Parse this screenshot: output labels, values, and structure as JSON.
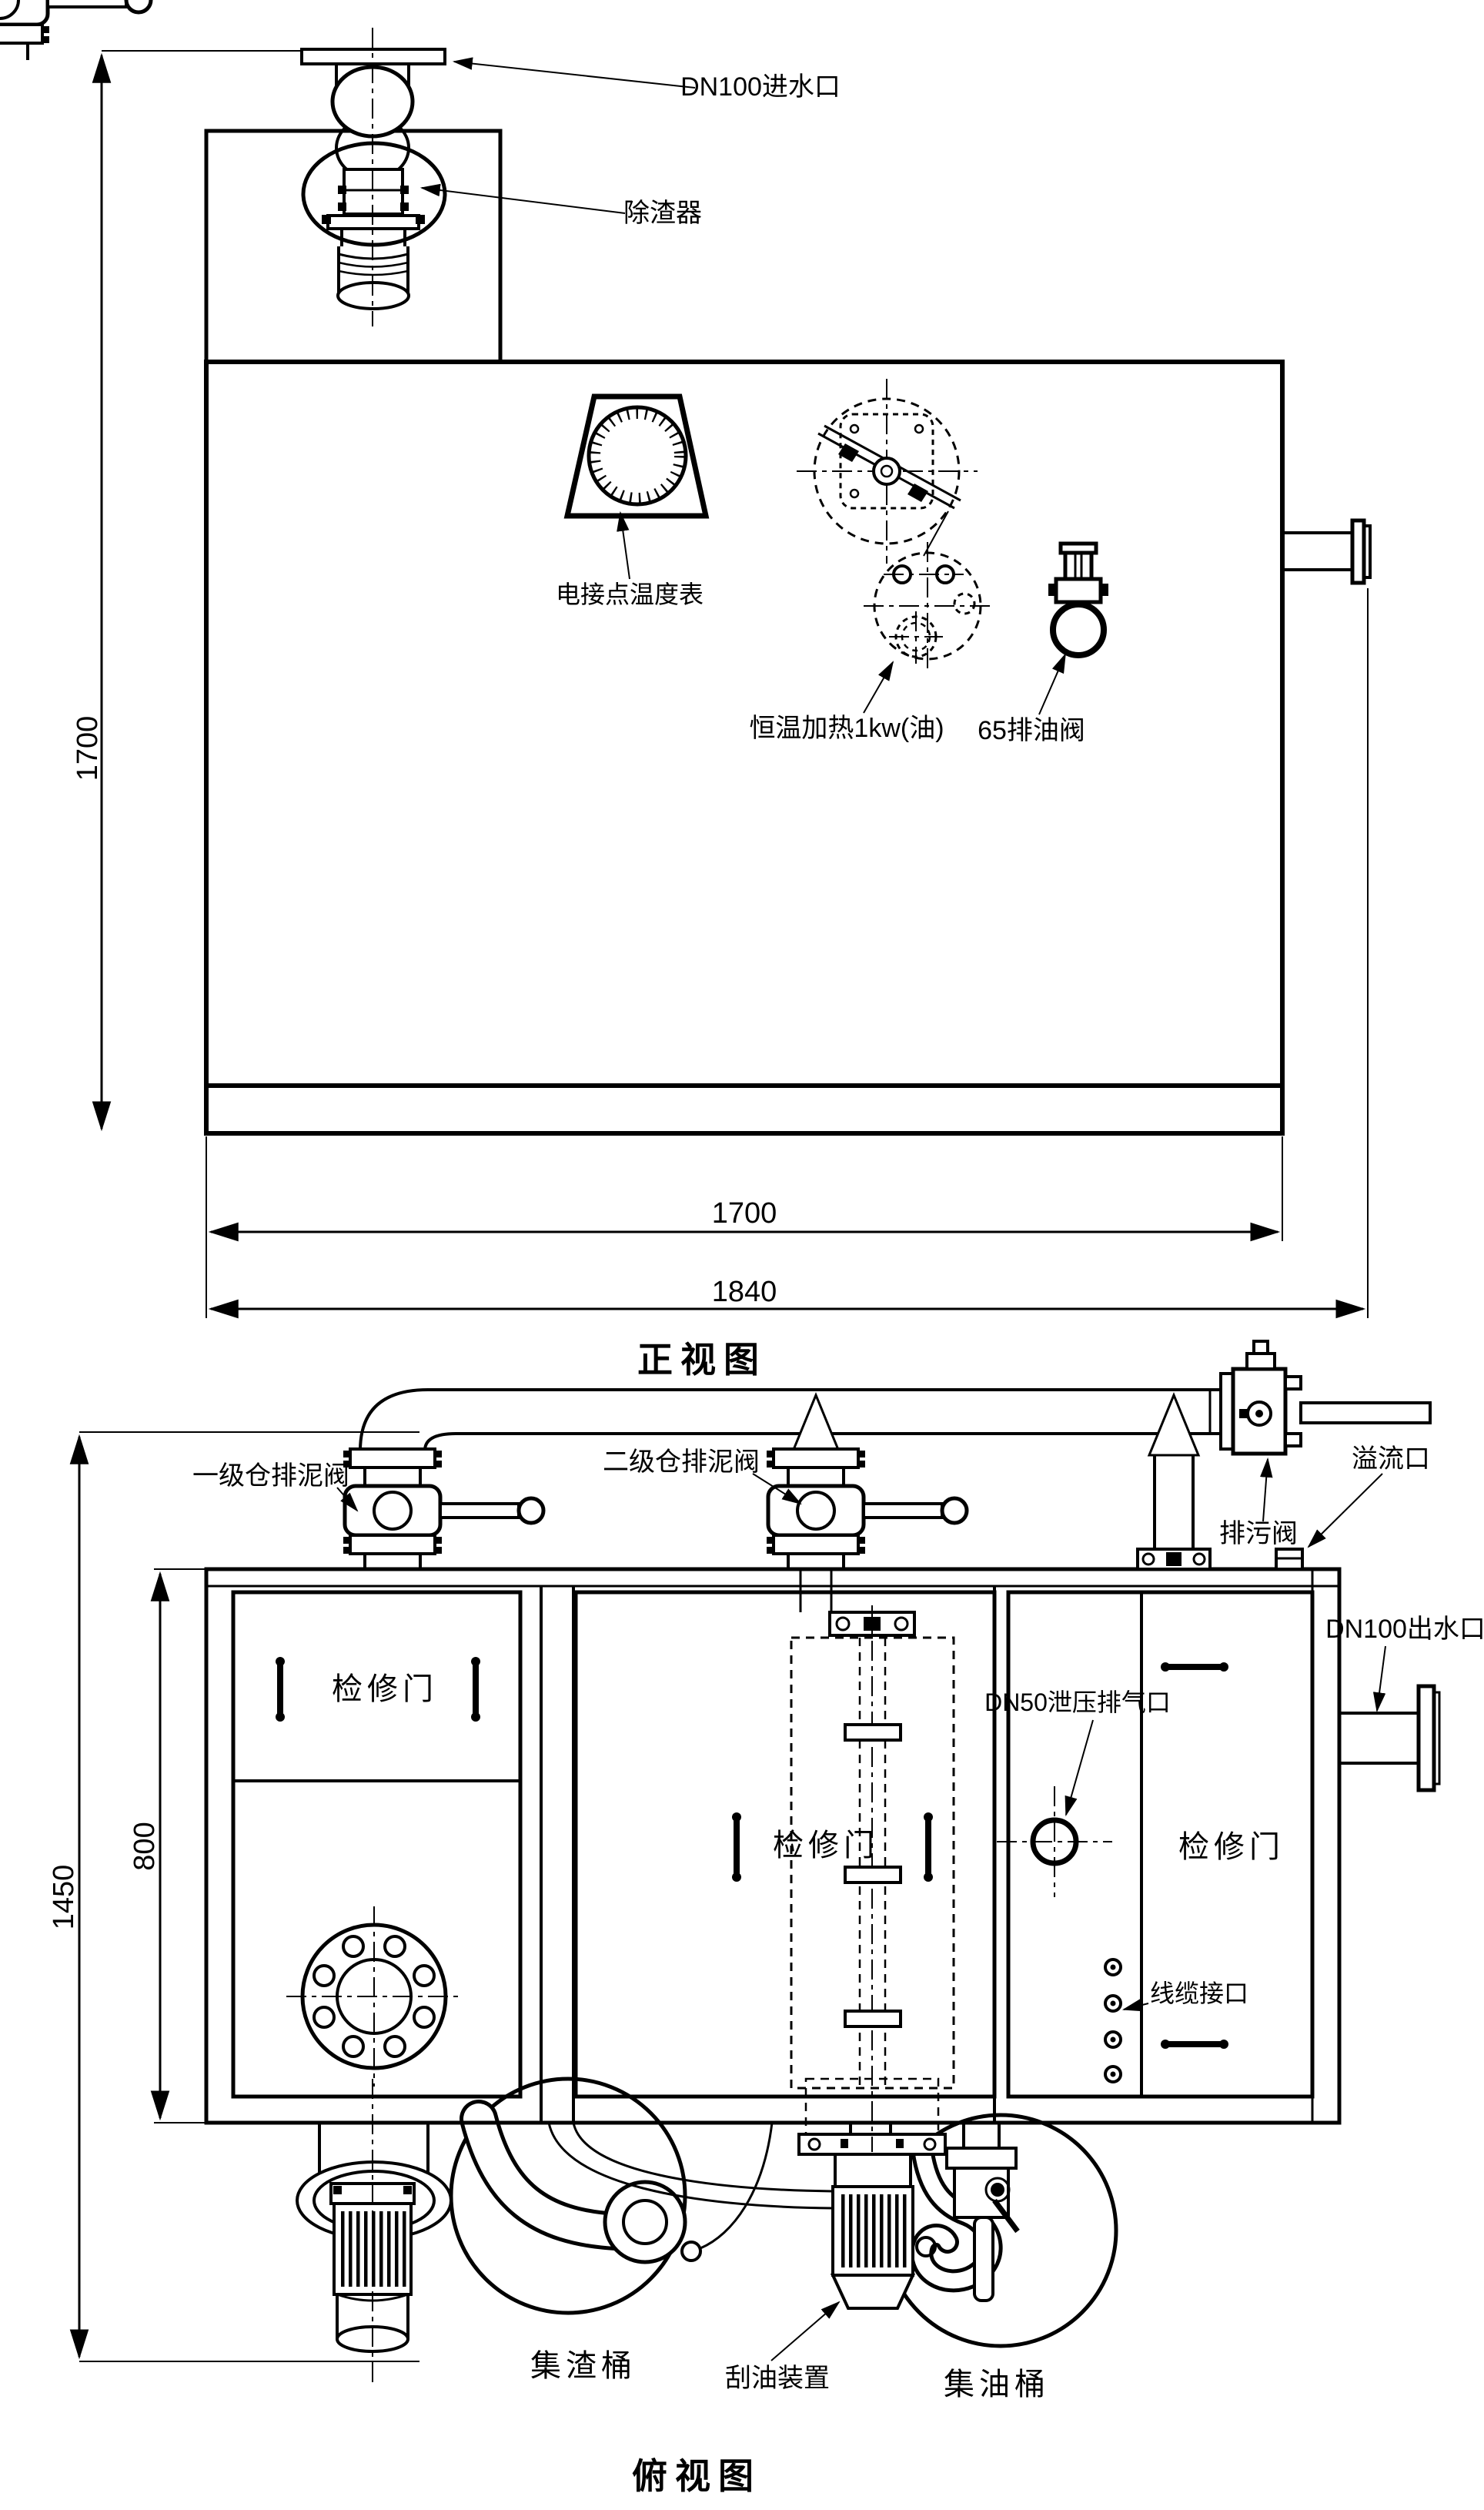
{
  "drawing": {
    "front": {
      "title": "正视图",
      "labels": {
        "inlet": "DN100进水口",
        "slag_remover": "除渣器",
        "temp_gauge": "电接点温度表",
        "heater": "恒温加热1kw(油)",
        "oil_valve": "65排油阀"
      },
      "dims": {
        "height": "1700",
        "inner_width": "1700",
        "outer_width": "1840"
      }
    },
    "top": {
      "title": "俯视图",
      "labels": {
        "stage1_valve": "一级仓排泥阀",
        "stage2_valve": "二级仓排泥阀",
        "drain_valve": "排污阀",
        "overflow": "溢流口",
        "outlet": "DN100出水口",
        "vent": "DN50泄压排气口",
        "cable_port": "线缆接口",
        "door": "检修门",
        "slag_barrel": "集渣桶",
        "scraper": "刮油装置",
        "oil_barrel": "集油桶"
      },
      "dims": {
        "height": "1450",
        "inner_height": "800"
      }
    },
    "colors": {
      "line": "#000000",
      "background": "#ffffff"
    }
  }
}
